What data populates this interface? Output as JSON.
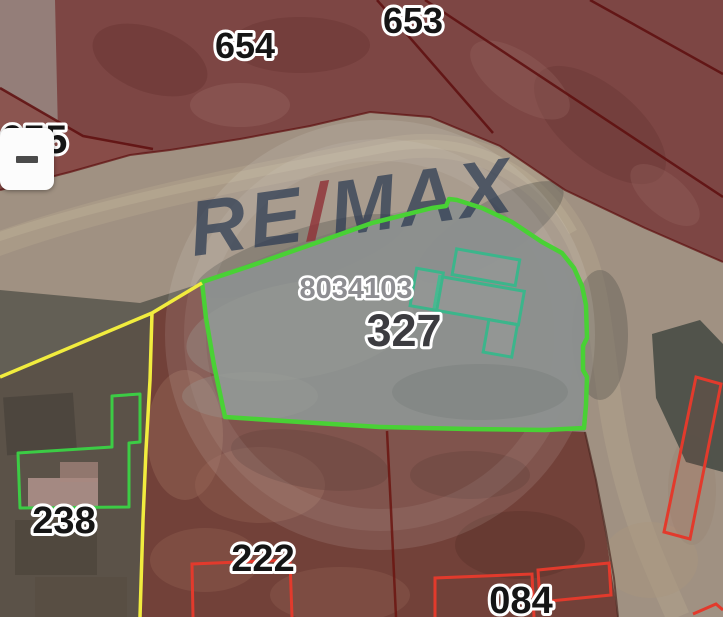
{
  "watermark": {
    "re": "RE",
    "slash": "/",
    "max": "MAX"
  },
  "controls": {
    "zoom_out_label": "−"
  },
  "parcels": {
    "p654": {
      "label": "654"
    },
    "p653": {
      "label": "653"
    },
    "p655": {
      "label": "655"
    },
    "selected": {
      "id": "8034103",
      "number": "327"
    },
    "p238": {
      "label": "238"
    },
    "p222": {
      "label": "222"
    },
    "p084": {
      "label": "084"
    }
  },
  "colors": {
    "selected_outline_green": "#49d135",
    "building_outline_teal": "#3cb58b",
    "building_outline_green": "#3ccc45",
    "boundary_yellow": "#f1ec3e",
    "building_outline_red": "#e23a2c",
    "parcel_boundary_dark_red": "#5e0e0e",
    "overlay_red_fill": "#7d4644",
    "overlay_maroon_fill": "#724139",
    "selected_fill_gray": "#8c8f8e",
    "watermark_navy": "#2b3a52",
    "watermark_red": "#8f3036"
  }
}
